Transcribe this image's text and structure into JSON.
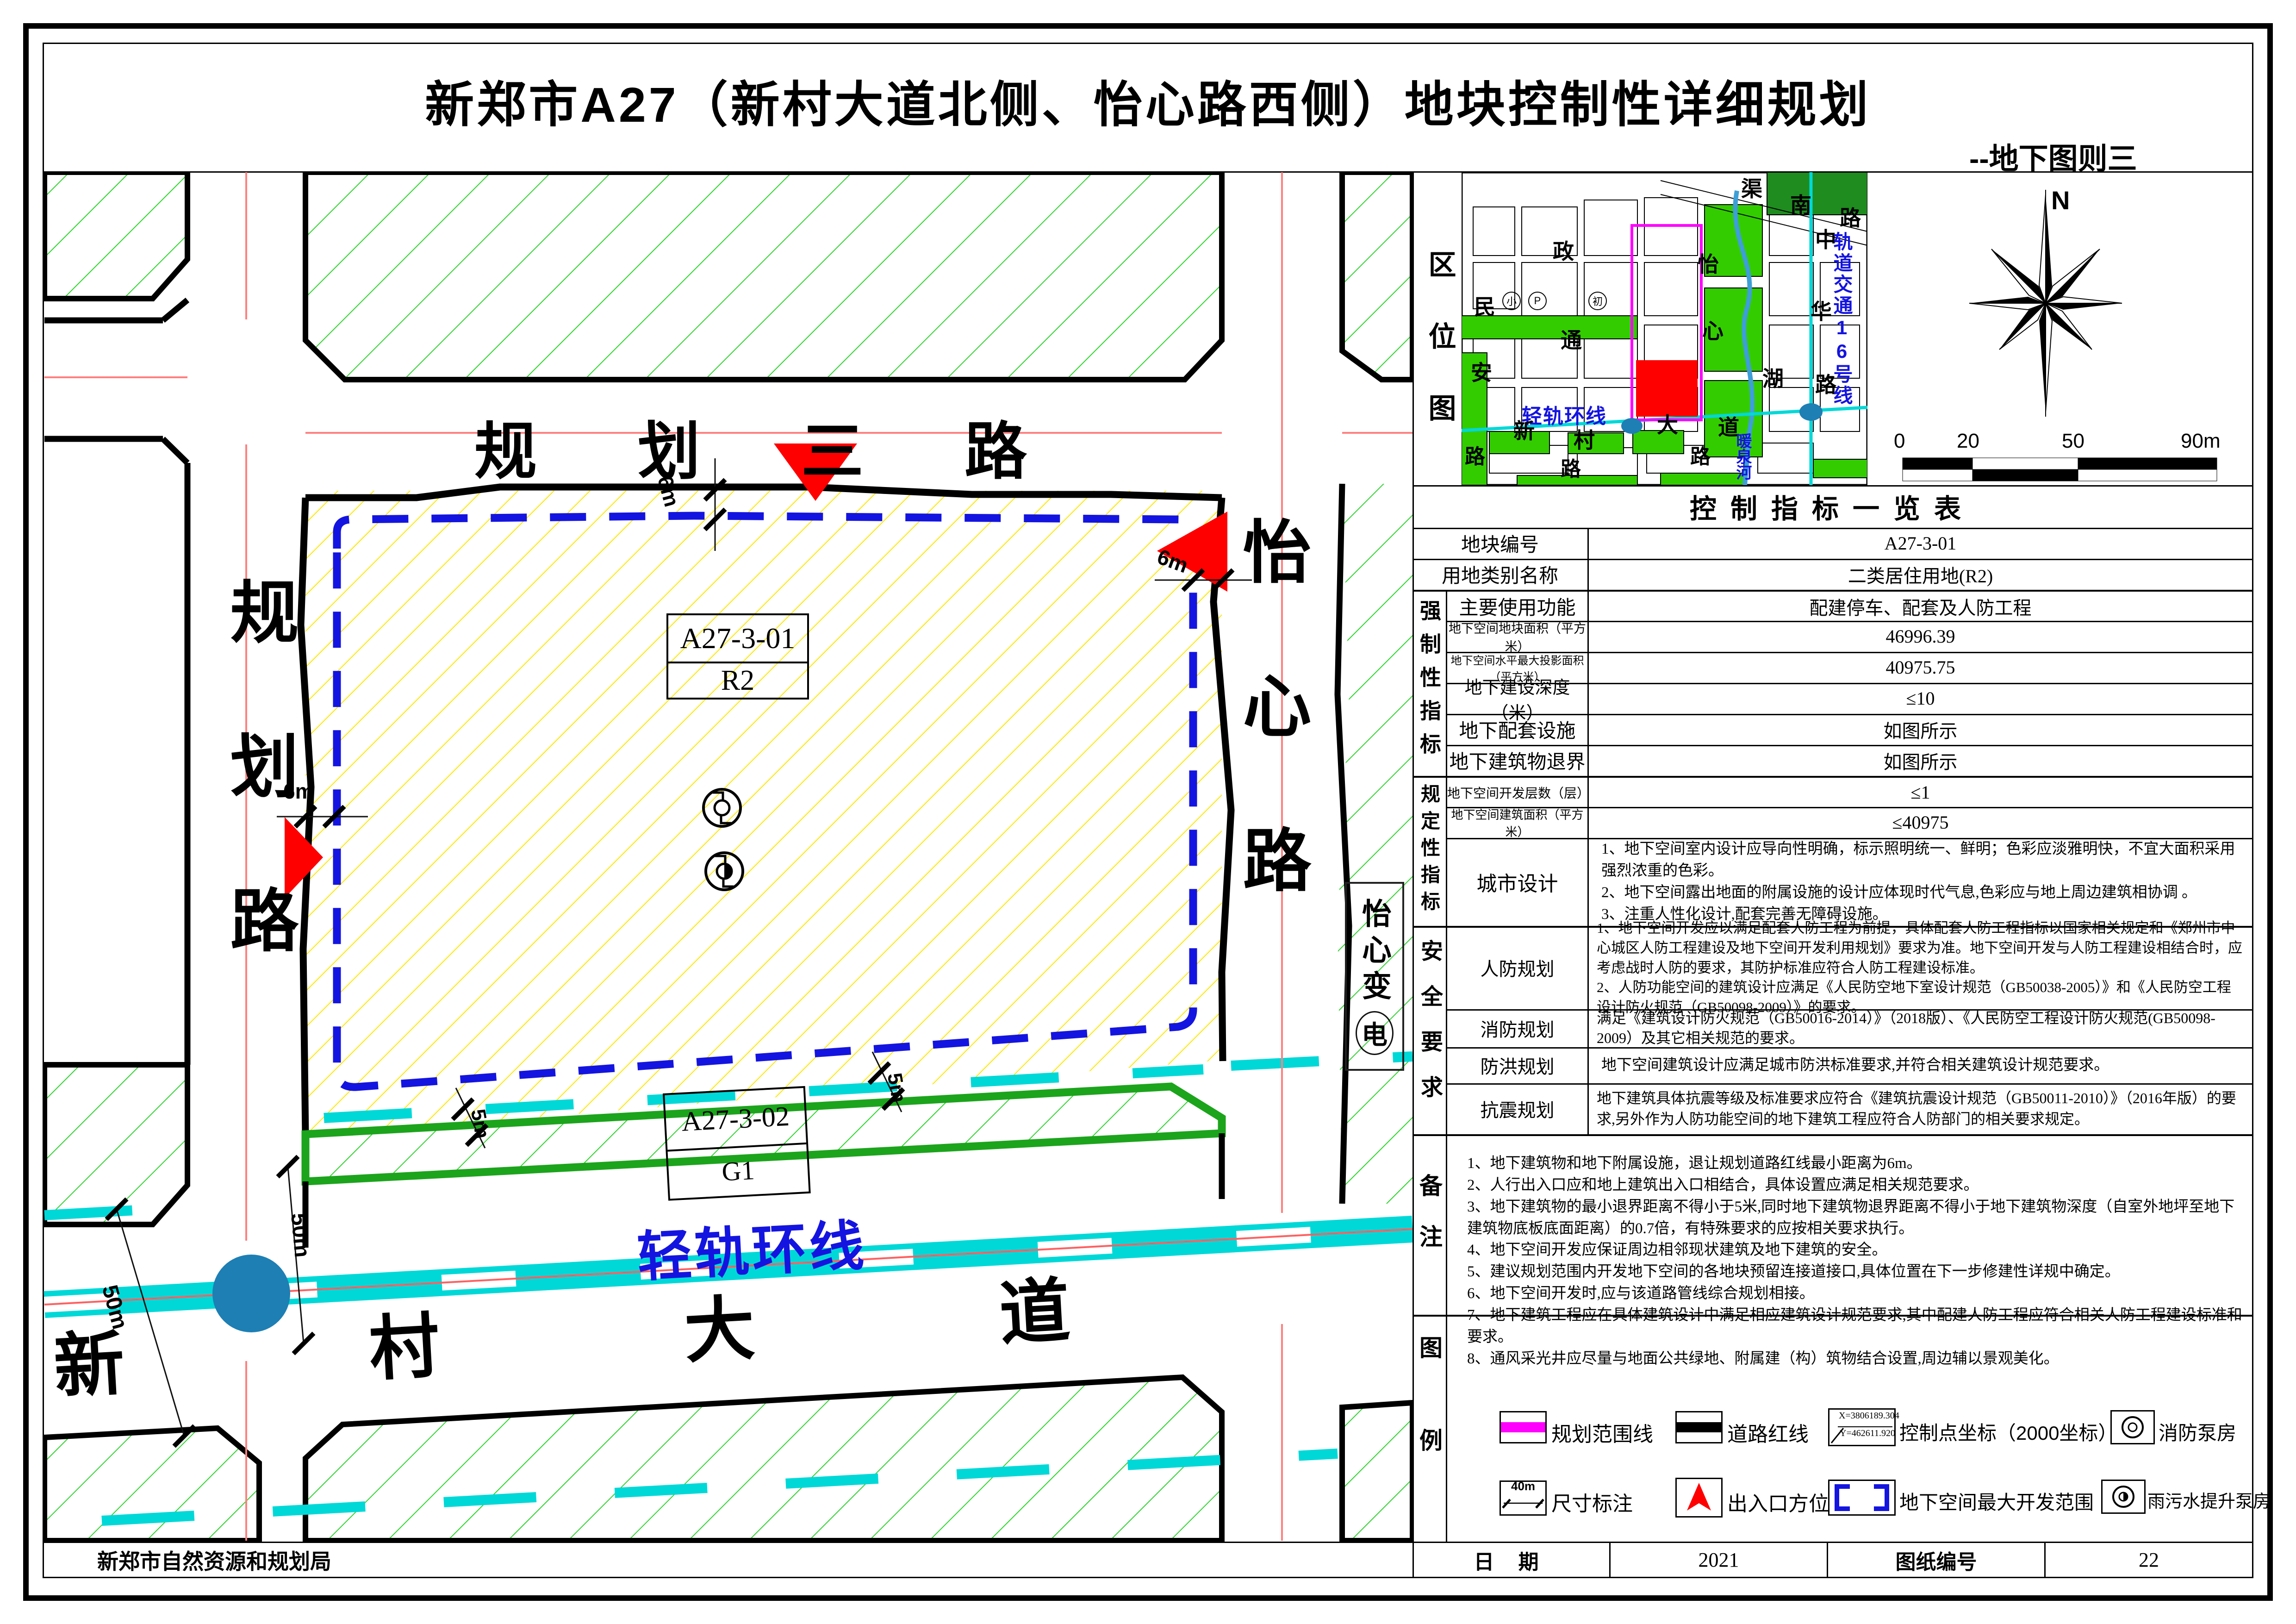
{
  "title": "新郑市A27（新村大道北侧、怡心路西侧）地块控制性详细规划",
  "subtitle": "--地下图则三",
  "agency": "新郑市自然资源和规划局",
  "footer": {
    "date_label": "日  期",
    "date_value": "2021",
    "sheet_label": "图纸编号",
    "sheet_value": "22"
  },
  "colors": {
    "hatch_yellow": "#ffe800",
    "hatch_green": "#2fd42f",
    "green_border": "#1ca41c",
    "cyan": "#00d8d8",
    "blue_dash": "#1414e0",
    "magenta": "#ff00ff",
    "red": "#fe0000",
    "centerline_pink": "#ff8080",
    "station_blue": "#1d7fb4",
    "dark_green": "#1e8c1e"
  },
  "map": {
    "road_north": "规划三路",
    "road_west": "规划路",
    "road_east": "怡心路",
    "road_south": "新村大道",
    "rail_label": "轻轨环线",
    "parcel_main_code": "A27-3-01",
    "parcel_main_use": "R2",
    "parcel_green_code": "A27-3-02",
    "parcel_green_use": "G1",
    "substation_a": "怡心变",
    "substation_b": "电",
    "d6": "6m",
    "d5": "5m",
    "d50": "50m"
  },
  "loc": {
    "title": "区位图",
    "qu": "渠",
    "nan": "南",
    "lu1": "路",
    "zheng": "政",
    "tong": "通",
    "min": "民",
    "an": "安",
    "yi": "怡",
    "xin": "心",
    "hu": "湖",
    "zhong": "中",
    "hua": "华",
    "lu2": "路",
    "rail16": "轨道交通16号线",
    "qinggui": "轻轨环线",
    "xin2": "新",
    "cun": "村",
    "da": "大",
    "dao": "道",
    "nuanquanhe": "暖泉河",
    "lu3": "路",
    "lu4": "路",
    "lu5": "路",
    "ic_xiao": "小",
    "ic_p": "P",
    "ic_chu": "初",
    "compass_n": "N",
    "s0": "0",
    "s20": "20",
    "s50": "50",
    "s90": "90m"
  },
  "table": {
    "title": "控制指标一览表",
    "group_mandatory": "强制性指标",
    "group_regulatory": "规定性指标",
    "group_safety": "安全要求",
    "group_notes": "备注",
    "group_legend": "图例",
    "rows": [
      {
        "label": "地块编号",
        "value": "A27-3-01"
      },
      {
        "label": "用地类别名称",
        "value": "二类居住用地(R2)"
      },
      {
        "label": "主要使用功能",
        "value": "配建停车、配套及人防工程"
      },
      {
        "label": "地下空间地块面积（平方米）",
        "value": "46996.39"
      },
      {
        "label": "地下空间水平最大投影面积（平方米）",
        "value": "40975.75"
      },
      {
        "label": "地下建设深度（米）",
        "value": "≤10"
      },
      {
        "label": "地下配套设施",
        "value": "如图所示"
      },
      {
        "label": "地下建筑物退界",
        "value": "如图所示"
      },
      {
        "label": "地下空间开发层数（层）",
        "value": "≤1"
      },
      {
        "label": "地下空间建筑面积（平方米）",
        "value": "≤40975"
      }
    ],
    "design_label": "城市设计",
    "design_text": "1、地下空间室内设计应导向性明确，标示照明统一、鲜明；色彩应淡雅明快，不宜大面积采用强烈浓重的色彩。\n2、地下空间露出地面的附属设施的设计应体现时代气息,色彩应与地上周边建筑相协调 。\n3、注重人性化设计,配套完善无障碍设施。",
    "renfang_label": "人防规划",
    "renfang_text": "1、地下空间开发应以满足配套人防工程为前提，具体配套人防工程指标以国家相关规定和《郑州市中心城区人防工程建设及地下空间开发利用规划》要求为准。地下空间开发与人防工程建设相结合时，应考虑战时人防的要求，其防护标准应符合人防工程建设标准。\n2、人防功能空间的建筑设计应满足《人民防空地下室设计规范（GB50038-2005）》和《人民防空工程设计防火规范（GB50098-2009）》的要求。",
    "xiaofang_label": "消防规划",
    "xiaofang_text": "满足《建筑设计防火规范（GB50016-2014）》（2018版）、《人民防空工程设计防火规范(GB50098-2009）及其它相关规范的要求。",
    "fanghong_label": "防洪规划",
    "fanghong_text": "地下空间建筑设计应满足城市防洪标准要求,并符合相关建筑设计规范要求。",
    "kangzhen_label": "抗震规划",
    "kangzhen_text": "地下建筑具体抗震等级及标准要求应符合《建筑抗震设计规范（GB50011-2010）》（2016年版）的要求,另外作为人防功能空间的地下建筑工程应符合人防部门的相关要求规定。",
    "notes_text": "1、地下建筑物和地下附属设施，退让规划道路红线最小距离为6m。\n2、人行出入口应和地上建筑出入口相结合，具体设置应满足相关规范要求。\n3、地下建筑物的最小退界距离不得小于5米,同时地下建筑物退界距离不得小于地下建筑物深度（自室外地坪至地下建筑物底板底面距离）的0.7倍，有特殊要求的应按相关要求执行。\n4、地下空间开发应保证周边相邻现状建筑及地下建筑的安全。\n5、建议规划范围内开发地下空间的各地块预留连接道接口,具体位置在下一步修建性详规中确定。\n6、地下空间开发时,应与该道路管线综合规划相接。\n7、地下建筑工程应在具体建筑设计中满足相应建筑设计规范要求,其中配建人防工程应符合相关人防工程建设标准和要求。\n8、通风采光井应尽量与地面公共绿地、附属建（构）筑物结合设置,周边辅以景观美化。"
  },
  "legend": {
    "boundary": "规划范围线",
    "redline": "道路红线",
    "ctrlpoint": "控制点坐标（2000坐标）",
    "ctrl_x": "X=3806189.304",
    "ctrl_y": "Y=462611.920",
    "firepump": "消防泵房",
    "dimension": "尺寸标注",
    "dim_sample": "40m",
    "entrance": "出入口方位",
    "maxrange": "地下空间最大开发范围",
    "sewagepump": "雨污水提升泵房"
  }
}
